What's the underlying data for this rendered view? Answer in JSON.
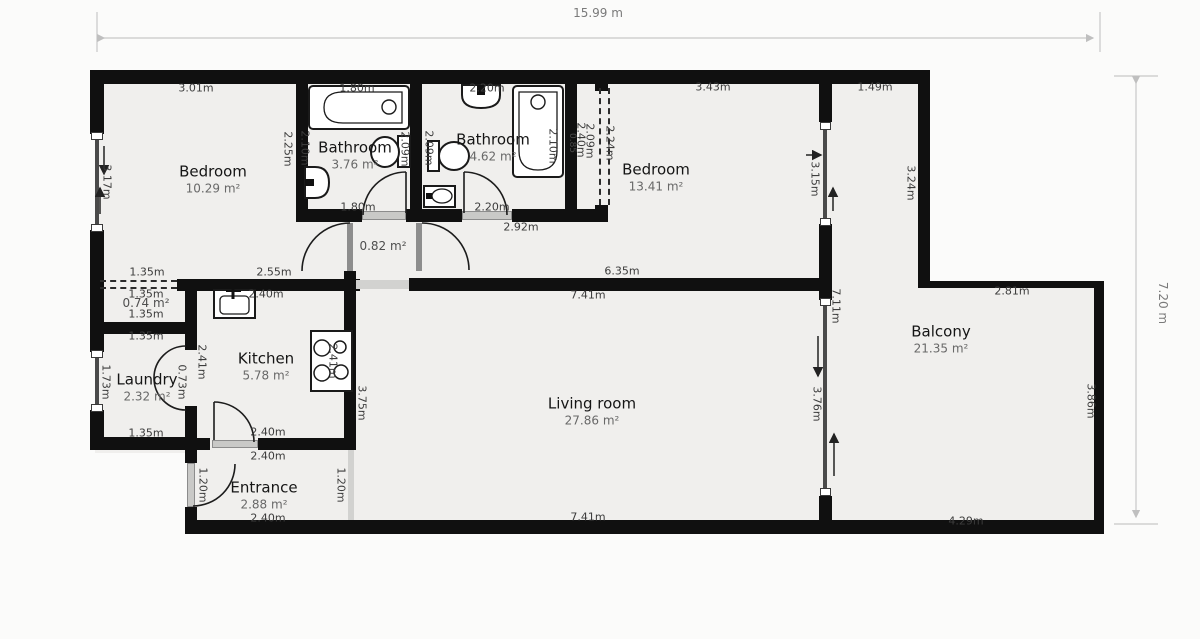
{
  "overall": {
    "width_label": "15.99 m",
    "height_label": "7.20 m"
  },
  "rooms": [
    {
      "id": "bedroom-1",
      "name": "Bedroom",
      "area": "10.29 m²"
    },
    {
      "id": "bathroom-1",
      "name": "Bathroom",
      "area": "3.76 m²"
    },
    {
      "id": "bathroom-2",
      "name": "Bathroom",
      "area": "4.62 m²"
    },
    {
      "id": "bedroom-2",
      "name": "Bedroom",
      "area": "13.41 m²"
    },
    {
      "id": "balcony",
      "name": "Balcony",
      "area": "21.35 m²"
    },
    {
      "id": "living-room",
      "name": "Living room",
      "area": "27.86 m²"
    },
    {
      "id": "kitchen",
      "name": "Kitchen",
      "area": "5.78 m²"
    },
    {
      "id": "laundry",
      "name": "Laundry",
      "area": "2.32 m²"
    },
    {
      "id": "entrance",
      "name": "Entrance",
      "area": "2.88 m²"
    },
    {
      "id": "hallway",
      "name": "",
      "area": "0.82 m²"
    },
    {
      "id": "closet",
      "name": "",
      "area": "0.74 m²"
    }
  ],
  "dims_h": [
    "3.01m",
    "1.80m",
    "2.20m",
    "3.43m",
    "1.49m",
    "1.80m",
    "2.20m",
    "2.92m",
    "1.35m",
    "2.55m",
    "6.35m",
    "7.41m",
    "2.81m",
    "1.35m",
    "1.35m",
    "2.40m",
    "1.35m",
    "1.35m",
    "2.40m",
    "2.40m",
    "2.40m",
    "7.41m",
    "4.29m"
  ],
  "dims_v": [
    "3.17m",
    "2.25m",
    "2.10m",
    "2.09m",
    "2.09m",
    "2.10m",
    "0.85",
    "2.40m",
    "2.09m",
    "2.24m",
    "3.15m",
    "3.24m",
    "7.11m",
    "2.41m",
    "2.41m",
    "1.73m",
    "0.73m",
    "3.75m",
    "3.76m",
    "1.20m",
    "1.20m",
    "3.86m"
  ],
  "icons": [
    "bathtub-icon",
    "toilet-icon",
    "sink-icon",
    "stove-icon",
    "kitchen-sink-icon",
    "door-arc",
    "window",
    "opening-arrow"
  ]
}
